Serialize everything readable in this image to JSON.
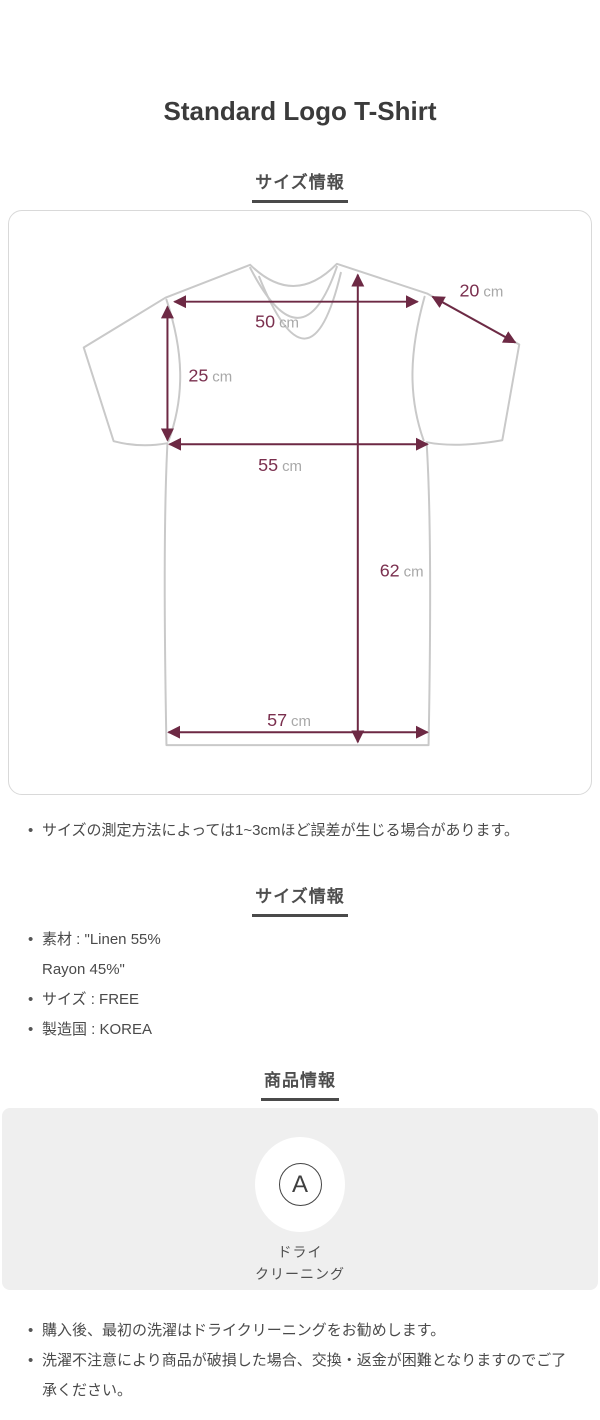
{
  "title": "Standard Logo T-Shirt",
  "headings": {
    "size_diagram": "サイズ情報",
    "size_info": "サイズ情報",
    "product_info": "商品情報"
  },
  "measurements": {
    "shoulder": {
      "value": "50",
      "unit": "cm"
    },
    "sleeve": {
      "value": "20",
      "unit": "cm"
    },
    "armhole": {
      "value": "25",
      "unit": "cm"
    },
    "chest": {
      "value": "55",
      "unit": "cm"
    },
    "length": {
      "value": "62",
      "unit": "cm"
    },
    "hem": {
      "value": "57",
      "unit": "cm"
    }
  },
  "size_note": "サイズの測定方法によっては1~3cmほど誤差が生じる場合があります。",
  "size_info": {
    "material_line1": "素材 : \"Linen 55%",
    "material_line2": "Rayon 45%\"",
    "size": "サイズ : FREE",
    "country": "製造国 : KOREA"
  },
  "care": {
    "symbol_letter": "A",
    "label_line1": "ドライ",
    "label_line2": "クリーニング"
  },
  "product_notes": {
    "0": "購入後、最初の洗濯はドライクリーニングをお勧めします。",
    "1": "洗濯不注意により商品が破損した場合、交換・返金が困難となりますのでご了承ください。"
  },
  "colors": {
    "measure_line": "#6d2944",
    "measure_value_text": "#7a2f4e",
    "measure_unit_text": "#a8a8a8",
    "shirt_outline": "#c9c9c9",
    "care_box_background": "#efefef",
    "heading_text": "#4e4e4e"
  }
}
